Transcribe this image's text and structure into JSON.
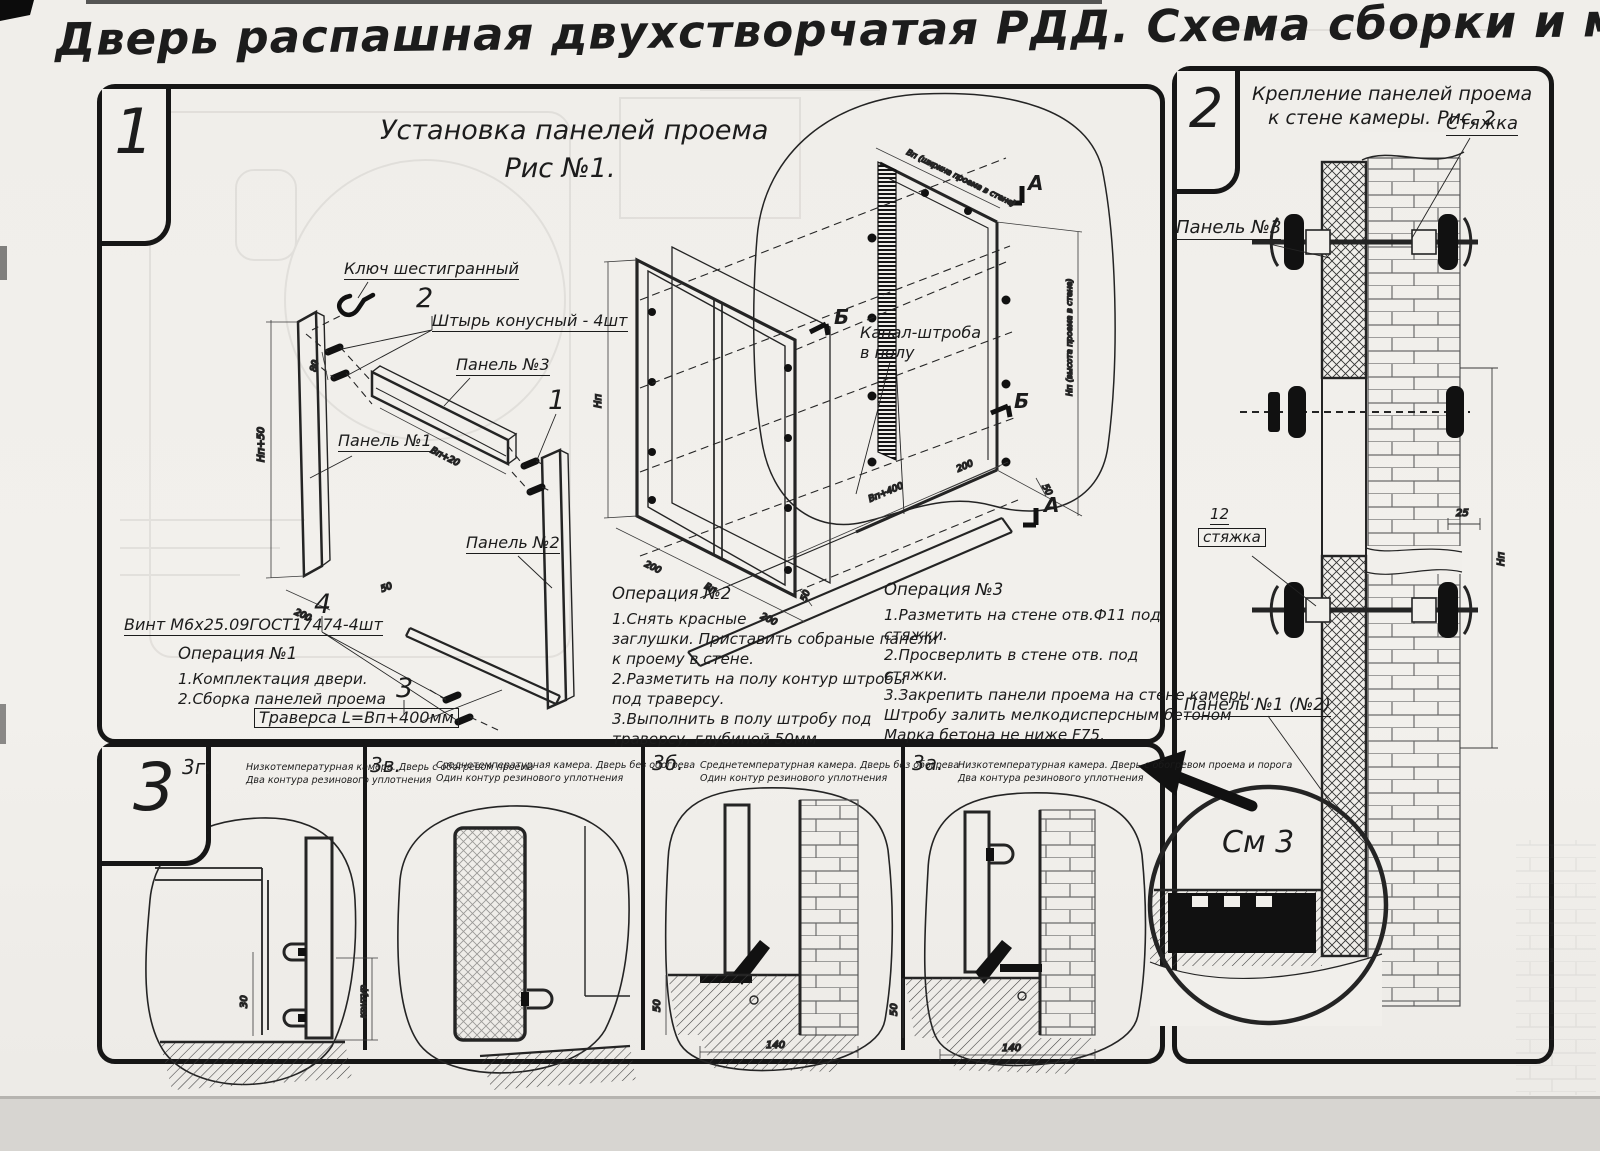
{
  "title": "Дверь распашная двухстворчатая РДД.  Схема сборки и монтажа №2",
  "p1": {
    "badge": "1",
    "fig_title1": "Установка панелей проема",
    "fig_title2": "Рис №1.",
    "lbl": {
      "hex_key": "Ключ шестигранный",
      "pin": "Штырь конусный - 4шт",
      "panel3": "Панель №3",
      "panel1": "Панель №1",
      "panel2": "Панель №2",
      "screw": "Винт М6х25.09ГОСТ17474-4шт",
      "traverse": "Траверса  L=Вп+400мм",
      "channel1": "Канал-штроба",
      "channel2": "в полу"
    },
    "call": {
      "c1": "1",
      "c2": "2",
      "c3": "3",
      "c4": "4"
    },
    "sec": {
      "a": "А",
      "b": "Б"
    },
    "dim": {
      "hp50": "Нп+50",
      "d200": "200",
      "d80": "80",
      "bp20": "Вп+20",
      "d50": "50",
      "hp": "Нп",
      "bp": "Вп",
      "bp400": "Вп+400",
      "wallw": "Вп (ширина проема в стене)",
      "wallh": "Нп (высота проема в стене)"
    },
    "op1": {
      "title": "Операция №1",
      "lines": [
        "1.Комплектация двери.",
        "2.Сборка панелей проема"
      ]
    },
    "op2": {
      "title": "Операция №2",
      "lines": [
        "1.Снять красные",
        "заглушки. Приставить собраные панели",
        "к проему в стене.",
        "2.Разметить на полу контур штробы",
        "под траверсу.",
        "3.Выполнить в полу штробу под",
        "траверсу, глубиной 50мм"
      ]
    },
    "op3": {
      "title": "Операция №3",
      "lines": [
        "1.Разметить на стене отв.Ф11 под",
        "стяжки.",
        "2.Просверлить в стене отв.  под",
        "стяжки.",
        "3.Закрепить панели проема на стене камеры.",
        "Штробу залить мелкодисперсным бетоном",
        "Марка бетона не ниже   F75."
      ]
    }
  },
  "p2": {
    "badge": "2",
    "title1": "Крепление панелей проема",
    "title2": "к стене камеры. Рис. 2",
    "lbl": {
      "tie": "Стяжка",
      "panel3": "Панель №3",
      "n12": "12",
      "tie2": "стяжка",
      "panel12": "Панель №1 (№2)",
      "see3": "См 3"
    },
    "dim": {
      "d25": "25",
      "hp": "Нп"
    }
  },
  "p3": {
    "badge": "3",
    "details": [
      {
        "id": "3г.",
        "cap1": "Низкотемпературная камера. Дверь с обогревом проема",
        "cap2": "Два контура резинового уплотнения"
      },
      {
        "id": "3в.",
        "cap1": "Среднетемпературная камера. Дверь без обогрева",
        "cap2": "Один контур резинового уплотнения"
      },
      {
        "id": "3б.",
        "cap1": "Среднетемпературная камера. Дверь без обогрева",
        "cap2": "Один контур резинового уплотнения"
      },
      {
        "id": "3а.",
        "cap1": "Низкотемпературная камера. Дверь с обогревом проема и порога",
        "cap2": "Два контура резинового уплотнения"
      }
    ],
    "dim": {
      "d140": "140",
      "d50": "50",
      "d30": "30",
      "contour": "контур"
    }
  }
}
